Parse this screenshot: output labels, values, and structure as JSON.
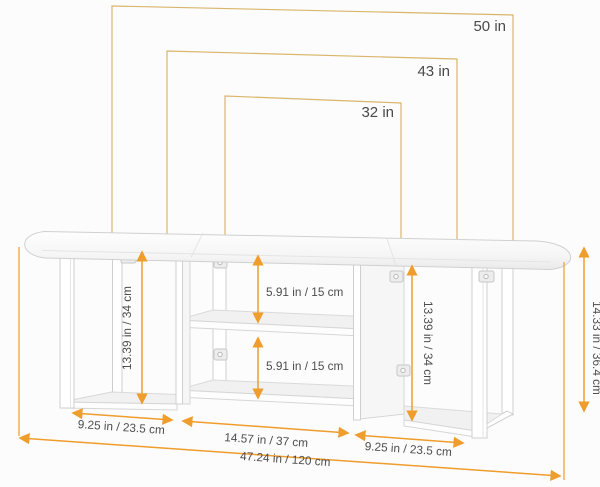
{
  "tv_compatibility": {
    "large": "50 in",
    "medium": "43 in",
    "small": "32 in"
  },
  "dimensions": {
    "left_section_width": "9.25 in / 23.5 cm",
    "middle_section_width": "14.57 in / 37 cm",
    "right_section_width": "9.25 in / 23.5 cm",
    "total_width": "47.24 in / 120 cm",
    "left_inner_height": "13.39 in / 34 cm",
    "right_inner_height": "13.39 in / 34 cm",
    "upper_shelf_gap": "5.91 in / 15 cm",
    "lower_shelf_gap": "5.91 in / 15 cm",
    "total_height": "14.33 in / 36.4 cm"
  },
  "colors": {
    "dimension_line": "#EF9D2C",
    "tv_outline": "#D9B66B",
    "label_text": "#4D4D4D"
  }
}
